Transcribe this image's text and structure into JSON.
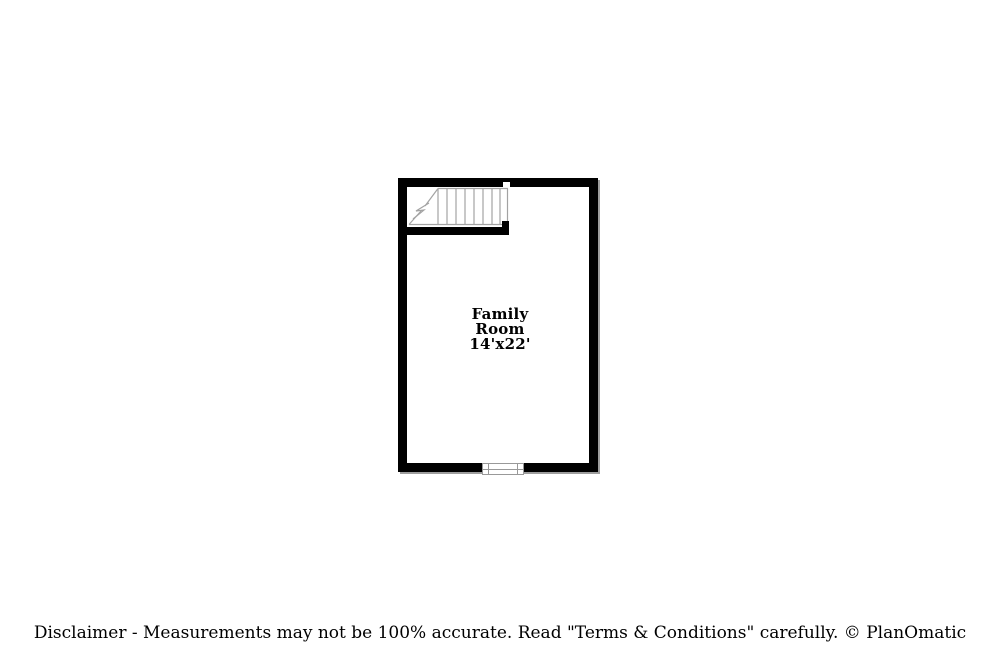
{
  "floorplan": {
    "room": {
      "name_lines": [
        "Family",
        "Room"
      ],
      "dimensions": "14'x22'"
    }
  },
  "footer": {
    "disclaimer": "Disclaimer - Measurements may not be 100% accurate. Read \"Terms & Conditions\" carefully. © PlanOmatic"
  },
  "colors": {
    "wall": "#000000",
    "stair_line": "#a3a3a3",
    "window_line": "#999999",
    "wall_shadow": "#9e9e9e",
    "text": "#000000",
    "background": "#ffffff"
  }
}
